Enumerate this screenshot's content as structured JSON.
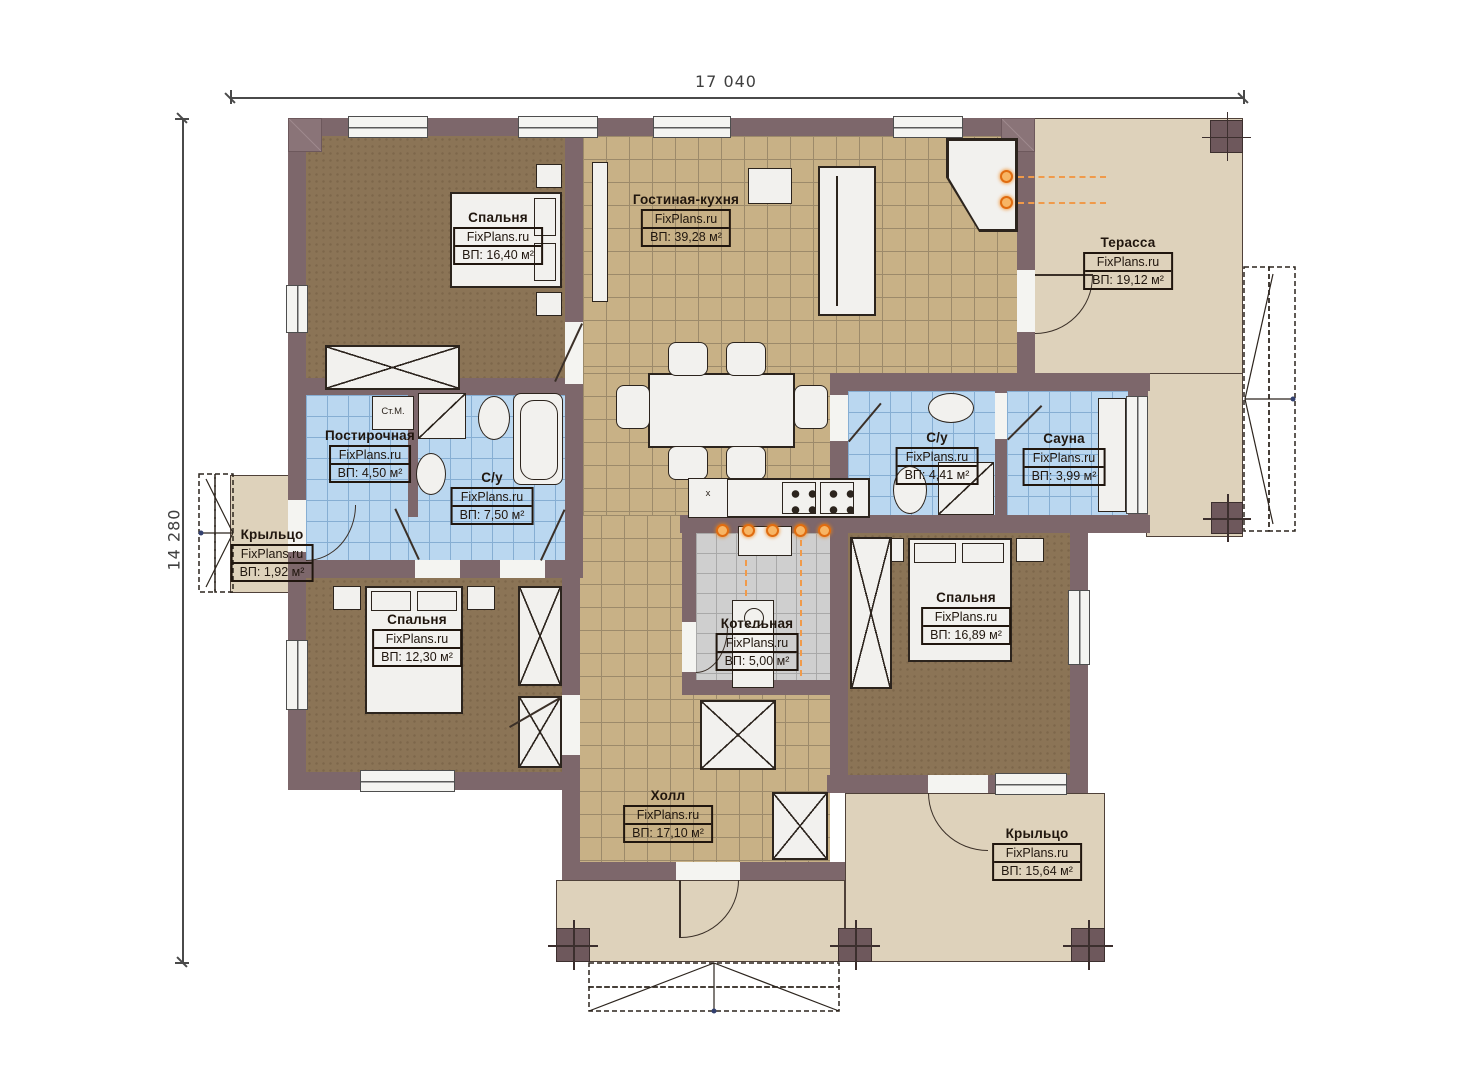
{
  "plan": {
    "dimensions": {
      "width_mm": "17 040",
      "height_mm": "14 280"
    }
  },
  "rooms": {
    "bedroom1": {
      "name": "Спальня",
      "brand": "FixPlans.ru",
      "area": "ВП: 16,40 м²"
    },
    "living_kitchen": {
      "name": "Гостиная-кухня",
      "brand": "FixPlans.ru",
      "area": "ВП: 39,28 м²"
    },
    "terrace": {
      "name": "Терасса",
      "brand": "FixPlans.ru",
      "area": "ВП: 19,12 м²"
    },
    "laundry": {
      "name": "Постирочная",
      "brand": "FixPlans.ru",
      "area": "ВП: 4,50 м²"
    },
    "bathroom1": {
      "name": "С/у",
      "brand": "FixPlans.ru",
      "area": "ВП: 7,50 м²"
    },
    "porch_left": {
      "name": "Крыльцо",
      "brand": "FixPlans.ru",
      "area": "ВП: 1,92 м²"
    },
    "bedroom2": {
      "name": "Спальня",
      "brand": "FixPlans.ru",
      "area": "ВП: 12,30 м²"
    },
    "bathroom2": {
      "name": "С/у",
      "brand": "FixPlans.ru",
      "area": "ВП: 4,41 м²"
    },
    "sauna": {
      "name": "Сауна",
      "brand": "FixPlans.ru",
      "area": "ВП: 3,99 м²"
    },
    "boiler": {
      "name": "Котельная",
      "brand": "FixPlans.ru",
      "area": "ВП: 5,00 м²"
    },
    "bedroom3": {
      "name": "Спальня",
      "brand": "FixPlans.ru",
      "area": "ВП: 16,89 м²"
    },
    "hall": {
      "name": "Холл",
      "brand": "FixPlans.ru",
      "area": "ВП: 17,10 м²"
    },
    "porch_right": {
      "name": "Крыльцо",
      "brand": "FixPlans.ru",
      "area": "ВП: 15,64 м²"
    }
  },
  "annotations": {
    "washing_machine": "Ст.М.",
    "kitchen_sink_mark": "x"
  },
  "colors": {
    "wall": "#7d676b",
    "bedroom_floor": "#8b7456",
    "tile_floor": "#c8b186",
    "bath_floor": "#bad7f0",
    "boiler_floor": "#cfcfcf",
    "porch_floor": "#ded2bb",
    "radiator_orange": "#e8770f"
  }
}
